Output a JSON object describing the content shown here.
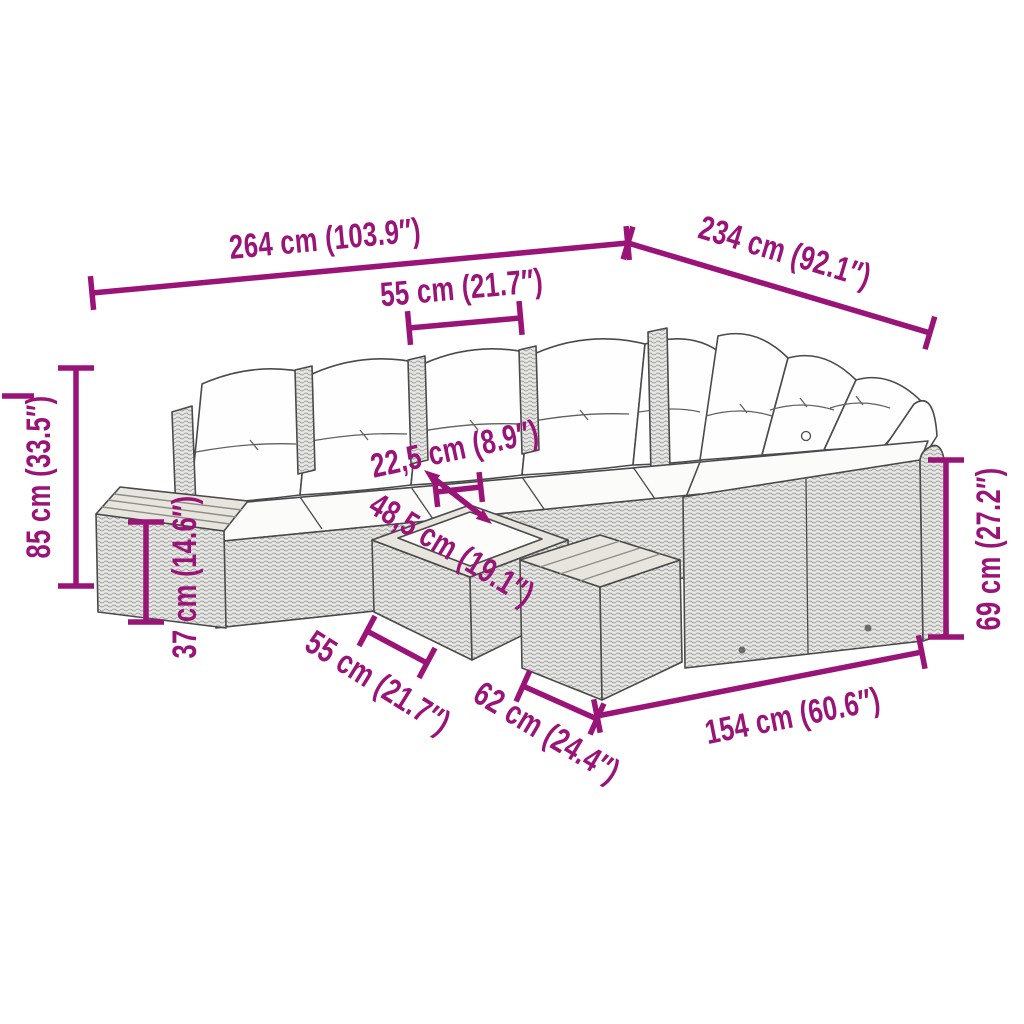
{
  "diagram": {
    "type": "product-dimension-diagram",
    "subject": "rattan-garden-lounge-set",
    "background": "#FFFFFF",
    "accent_color": "#9A1477",
    "line_color": "#4A4A4A",
    "dimensions": [
      {
        "id": "overall-length",
        "label": "264 cm (103.9″)",
        "cm": "264",
        "inches": "103.9"
      },
      {
        "id": "overall-depth",
        "label": "234 cm (92.1″)",
        "cm": "234",
        "inches": "92.1"
      },
      {
        "id": "seat-module-width",
        "label": "55 cm (21.7″)",
        "cm": "55",
        "inches": "21.7"
      },
      {
        "id": "back-height",
        "label": "85 cm (33.5″)",
        "cm": "85",
        "inches": "33.5"
      },
      {
        "id": "side-table-height",
        "label": "37 cm (14.6″)",
        "cm": "37",
        "inches": "14.6"
      },
      {
        "id": "seat-to-table-gap",
        "label": "22,5 cm (8.9″)",
        "cm": "22,5",
        "inches": "8.9"
      },
      {
        "id": "table-top-size",
        "label": "48,5 cm (19.1″)",
        "cm": "48,5",
        "inches": "19.1"
      },
      {
        "id": "coffee-table-width",
        "label": "55 cm (21.7″)",
        "cm": "55",
        "inches": "21.7"
      },
      {
        "id": "stool-width",
        "label": "62 cm (24.4″)",
        "cm": "62",
        "inches": "24.4"
      },
      {
        "id": "right-section-length",
        "label": "154 cm (60.6″)",
        "cm": "154",
        "inches": "60.6"
      },
      {
        "id": "arm-back-height",
        "label": "69 cm (27.2″)",
        "cm": "69",
        "inches": "27.2"
      }
    ]
  }
}
